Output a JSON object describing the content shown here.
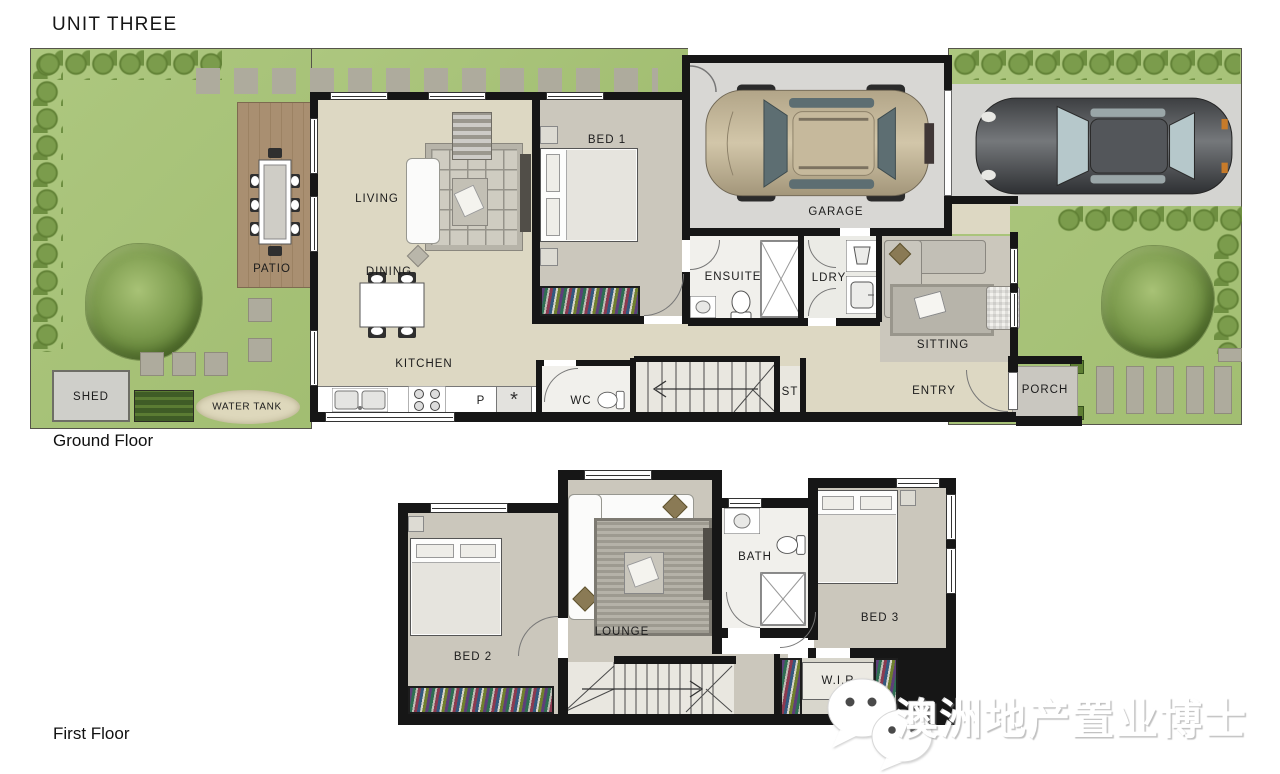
{
  "title": "UNIT THREE",
  "ground_floor": {
    "caption": "Ground Floor",
    "labels": {
      "living": "LIVING",
      "dining": "DINING",
      "kitchen": "KITCHEN",
      "pantry": "P",
      "fridge": "*",
      "wc": "WC",
      "st": "ST",
      "bed1": "BED 1",
      "ensuite": "ENSUITE",
      "ldry": "LDRY",
      "garage": "GARAGE",
      "sitting": "SITTING",
      "entry": "ENTRY",
      "porch": "PORCH",
      "patio": "PATIO",
      "shed": "SHED",
      "water_tank": "WATER TANK"
    }
  },
  "first_floor": {
    "caption": "First Floor",
    "labels": {
      "bed2": "BED 2",
      "lounge": "LOUNGE",
      "bath": "BATH",
      "bed3": "BED 3",
      "wir": "W.I.R"
    }
  },
  "watermark": {
    "icon": "wechat-icon",
    "text": "澳洲地产置业博士"
  },
  "colors": {
    "grass": "#a7c37c",
    "hedge": "#5d7d32",
    "floor_beige": "#ddd8c3",
    "carpet": "#cbc7bc",
    "garage_floor": "#d8d7d4",
    "driveway": "#d4d4d1",
    "deck": "#a98f71",
    "wall": "#161616"
  }
}
